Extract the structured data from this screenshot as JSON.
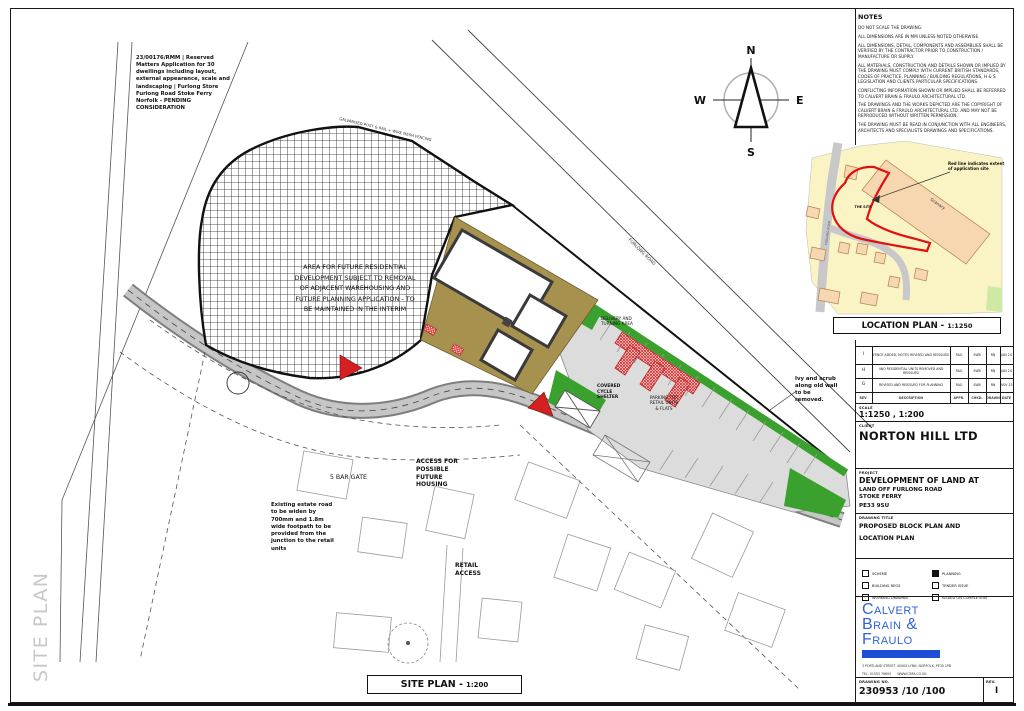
{
  "sheet": {
    "side_label": "SITE PLAN"
  },
  "notes": {
    "title": "NOTES",
    "lines": [
      "DO NOT SCALE THE DRAWING.",
      "ALL DIMENSIONS ARE IN mm UNLESS NOTED OTHERWISE.",
      "ALL DIMENSIONS, DETAIL, COMPONENTS AND ASSEMBLIES SHALL BE VERIFIED BY THE CONTRACTOR PRIOR TO CONSTRUCTION / MANUFACTURE OR SUPPLY.",
      "ALL MATERIALS, CONSTRUCTION AND DETAILS SHOWN OR IMPLIED BY THE DRAWING MUST COMPLY WITH CURRENT BRITISH STANDARDS, CODES OF PRACTICE, PLANNING / BUILDING REGULATIONS, H & S LEGISLATION AND CLIENTS PARTICULAR SPECIFICATIONS.",
      "CONFLICTING INFORMATION SHOWN OR IMPLIED SHALL BE REFERRED TO CALVERT BRAIN & FRAULO ARCHITECTURAL LTD.",
      "THE DRAWINGS AND THE WORKS DEPICTED ARE THE COPYRIGHT OF CALVERT BRAIN & FRAULO ARCHITECTURAL LTD. AND MAY NOT BE REPRODUCED WITHOUT WRITTEN PERMISSION.",
      "THE DRAWING MUST BE READ IN CONJUNCTION WITH ALL ENGINEERS, ARCHITECTS AND SPECIALISTS DRAWINGS AND SPECIFICATIONS."
    ]
  },
  "compass": {
    "n": "N",
    "e": "E",
    "s": "S",
    "w": "W"
  },
  "location_plan": {
    "box_label": "LOCATION PLAN -",
    "box_scale": "1:1250",
    "annotation": "Red line indicates extent of application site",
    "site_label": "THE SITE",
    "granary_label": "Granary",
    "road_label": "FURLONG ROAD"
  },
  "site_plan": {
    "box_label": "SITE PLAN -",
    "box_scale": "1:200",
    "planning_app_note": "23/00176/RMM | Reserved Matters Application for 30 dwellings including layout, external appearance, scale and landscaping | Furlong Store Furlong Road Stoke Ferry Norfolk - PENDING CONSIDERATION",
    "future_area_note": "AREA FOR FUTURE RESIDENTIAL DEVELOPMENT SUBJECT TO REMOVAL OF ADJACENT WAREHOUSING AND FUTURE PLANNING APPLICATION - TO BE MAINTAINED IN THE INTERIM",
    "fence_note": "GALVANISED POST & RAIL + WIRE MESH FENCING",
    "access_note": "ACCESS FOR POSSIBLE FUTURE HOUSING",
    "gate_note": "5 BAR GATE",
    "estate_road_note": "Existing estate road to be widen by 700mm and 1.8m wide footpath to be provided from the junction to the retail units",
    "retail_access_note": "RETAIL ACCESS",
    "ivy_note": "Ivy and scrub along old wall to be removed.",
    "cycle_note": "COVERED CYCLE SHELTER",
    "parking_note": "PARKING FOR RETAIL UNITS & FLATS",
    "delivery_note": "DELIVERY AND TURNING AREA",
    "road_label": "FURLONG ROAD"
  },
  "title_block": {
    "revision_table": {
      "headers": {
        "rev": "REV.",
        "description": "DESCRIPTION",
        "appr": "APPR.",
        "chkd": "CHKD.",
        "drawn": "DRAWN",
        "date": "DATE"
      },
      "rows": [
        {
          "rev": "I",
          "description": "FENCE ADDED, NOTES REVISED AND REISSUED",
          "appr": "RAG",
          "chkd": "SWB",
          "drawn": "RN",
          "date": "JAN 24"
        },
        {
          "rev": "H",
          "description": "4No RESIDENTIAL UNITS REMOVED AND REISSUED",
          "appr": "RAG",
          "chkd": "SWB",
          "drawn": "RN",
          "date": "JAN 24"
        },
        {
          "rev": "G",
          "description": "REVISED AND REISSUED FOR PLANNING",
          "appr": "RAG",
          "chkd": "SWB",
          "drawn": "RN",
          "date": "NOV 23"
        }
      ]
    },
    "scale": {
      "label": "SCALE",
      "value": "1:1250 , 1:200"
    },
    "client": {
      "label": "CLIENT",
      "value": "NORTON HILL LTD"
    },
    "project": {
      "label": "PROJECT",
      "line1": "DEVELOPMENT OF LAND AT",
      "line2": "LAND OFF FURLONG ROAD",
      "line3": "STOKE FERRY",
      "line4": "PE33 9SU"
    },
    "drawing_title": {
      "label": "DRAWING TITLE",
      "value": "PROPOSED BLOCK PLAN AND LOCATION PLAN"
    },
    "status_checkboxes": [
      {
        "label": "SCHEME",
        "checked": false
      },
      {
        "label": "BUILDING REGS",
        "checked": false
      },
      {
        "label": "WORKING DRAWING",
        "checked": false
      },
      {
        "label": "PLANNING",
        "checked": true
      },
      {
        "label": "TENDER ISSUE",
        "checked": false
      },
      {
        "label": "ISSUED ON COMPLETION",
        "checked": false
      }
    ],
    "firm": {
      "name_line1": "Calvert",
      "name_line2": "Brain &",
      "name_line3": "Fraulo",
      "address": "3 PORTLAND STREET, KINGS LYNN, NORFOLK, PE30 1PB",
      "contact": "TEL: 01553 76600      WWW.CBFA.CO.UK"
    },
    "drawing_no": {
      "label": "DRAWING NO.",
      "value": "230953 /10 /100"
    },
    "rev": {
      "label": "REV.",
      "value": "I"
    }
  }
}
